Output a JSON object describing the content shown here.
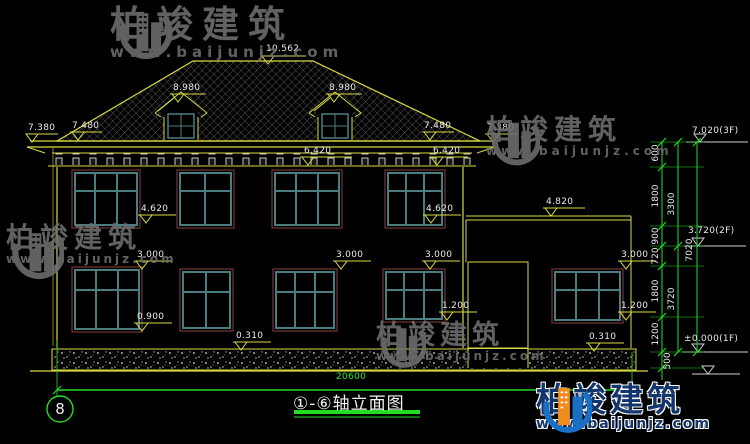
{
  "meta": {
    "background": "#000000",
    "line_yellow": "#d9d943",
    "dimension_green": "#22dd22",
    "window_frame_teal": "#4a7d80",
    "window_opening_maroon": "#5c2b2b",
    "text_white": "#e9e9e9",
    "brand_blue": "#1a6fc4",
    "brand_orange": "#f08c1e"
  },
  "brand": {
    "name": "柏竣建筑",
    "url": "www.baijunjz.com"
  },
  "titleblock": {
    "axis": "8",
    "title": "①-⑥轴立面图"
  },
  "dims": {
    "ridge": "10.562",
    "dormer_left": "8.980",
    "dormer_right": "8.980",
    "eave_far_left": "7.380",
    "eave_left": "7.480",
    "eave_right": "7.480",
    "eave_far_right": "7.380",
    "cornice_left": "6.420",
    "cornice_right": "6.420",
    "sill2_left": "4.620",
    "sill2_right": "4.620",
    "wing_roof": "4.820",
    "win1_top_a": "3.000",
    "win1_top_b": "3.000",
    "win1_top_c": "3.000",
    "win1_top_d": "3.000",
    "sill1_a": "0.900",
    "sill1_c": "1.200",
    "sill1_d": "1.200",
    "plinth_left": "0.310",
    "plinth_right": "0.310",
    "total_width": "20600"
  },
  "levels": {
    "f3": "7.020(3F)",
    "f2": "3.720(2F)",
    "f1": "±0.000(1F)"
  },
  "chain": {
    "s600": "600",
    "s1800a": "1800",
    "s900": "900",
    "s720": "720",
    "s1800b": "1800",
    "s1200": "1200",
    "s500": "500",
    "t3300": "3300",
    "t3720": "3720",
    "t7020": "7020"
  }
}
